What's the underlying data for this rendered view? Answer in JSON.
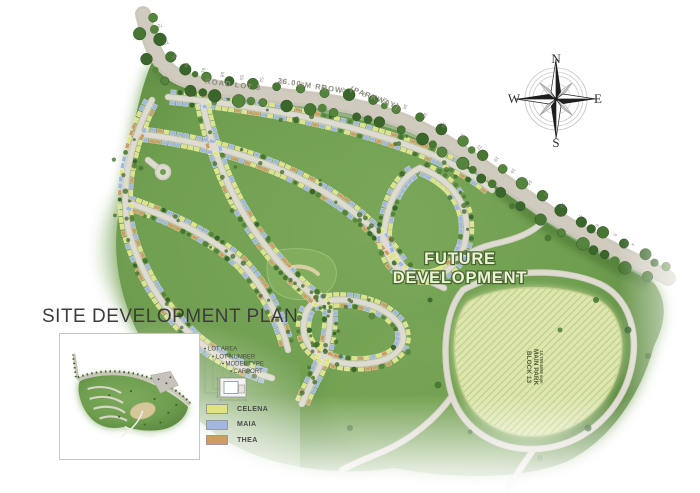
{
  "title": "SITE DEVELOPMENT PLAN",
  "compass": {
    "north": "N",
    "south": "S",
    "east": "E",
    "west": "W"
  },
  "map": {
    "future_development": {
      "line1": "FUTURE",
      "line2": "DEVELOPMENT"
    },
    "main_park": {
      "block": "BLOCK 13",
      "name": "MAIN PARK",
      "area": "10,799.6098 sqm"
    },
    "road": {
      "name": "ROAD LOT 3",
      "row": "26.00 M RROW",
      "alias": "(PARKWAY)"
    },
    "parkway_lot_numbers": [
      72,
      70,
      69,
      64,
      61,
      58,
      55,
      52,
      50,
      48,
      45,
      43,
      40,
      37,
      34,
      31,
      28,
      26,
      22,
      19,
      16,
      14,
      11,
      10,
      7,
      6,
      5,
      4
    ]
  },
  "legend": {
    "callouts": [
      "LOT AREA",
      "LOT NUMBER",
      "MODEL TYPE",
      "CARPORT"
    ],
    "models": [
      {
        "name": "CELENA",
        "color": "#dfe381"
      },
      {
        "name": "MAIA",
        "color": "#a2b6df"
      },
      {
        "name": "THEA",
        "color": "#cd9d62"
      }
    ]
  },
  "colors": {
    "land_green": "#6f9e4f",
    "road_gray": "#dedbd0",
    "tree_green": "#3d682c",
    "park_hatch": "#dce6ad"
  }
}
